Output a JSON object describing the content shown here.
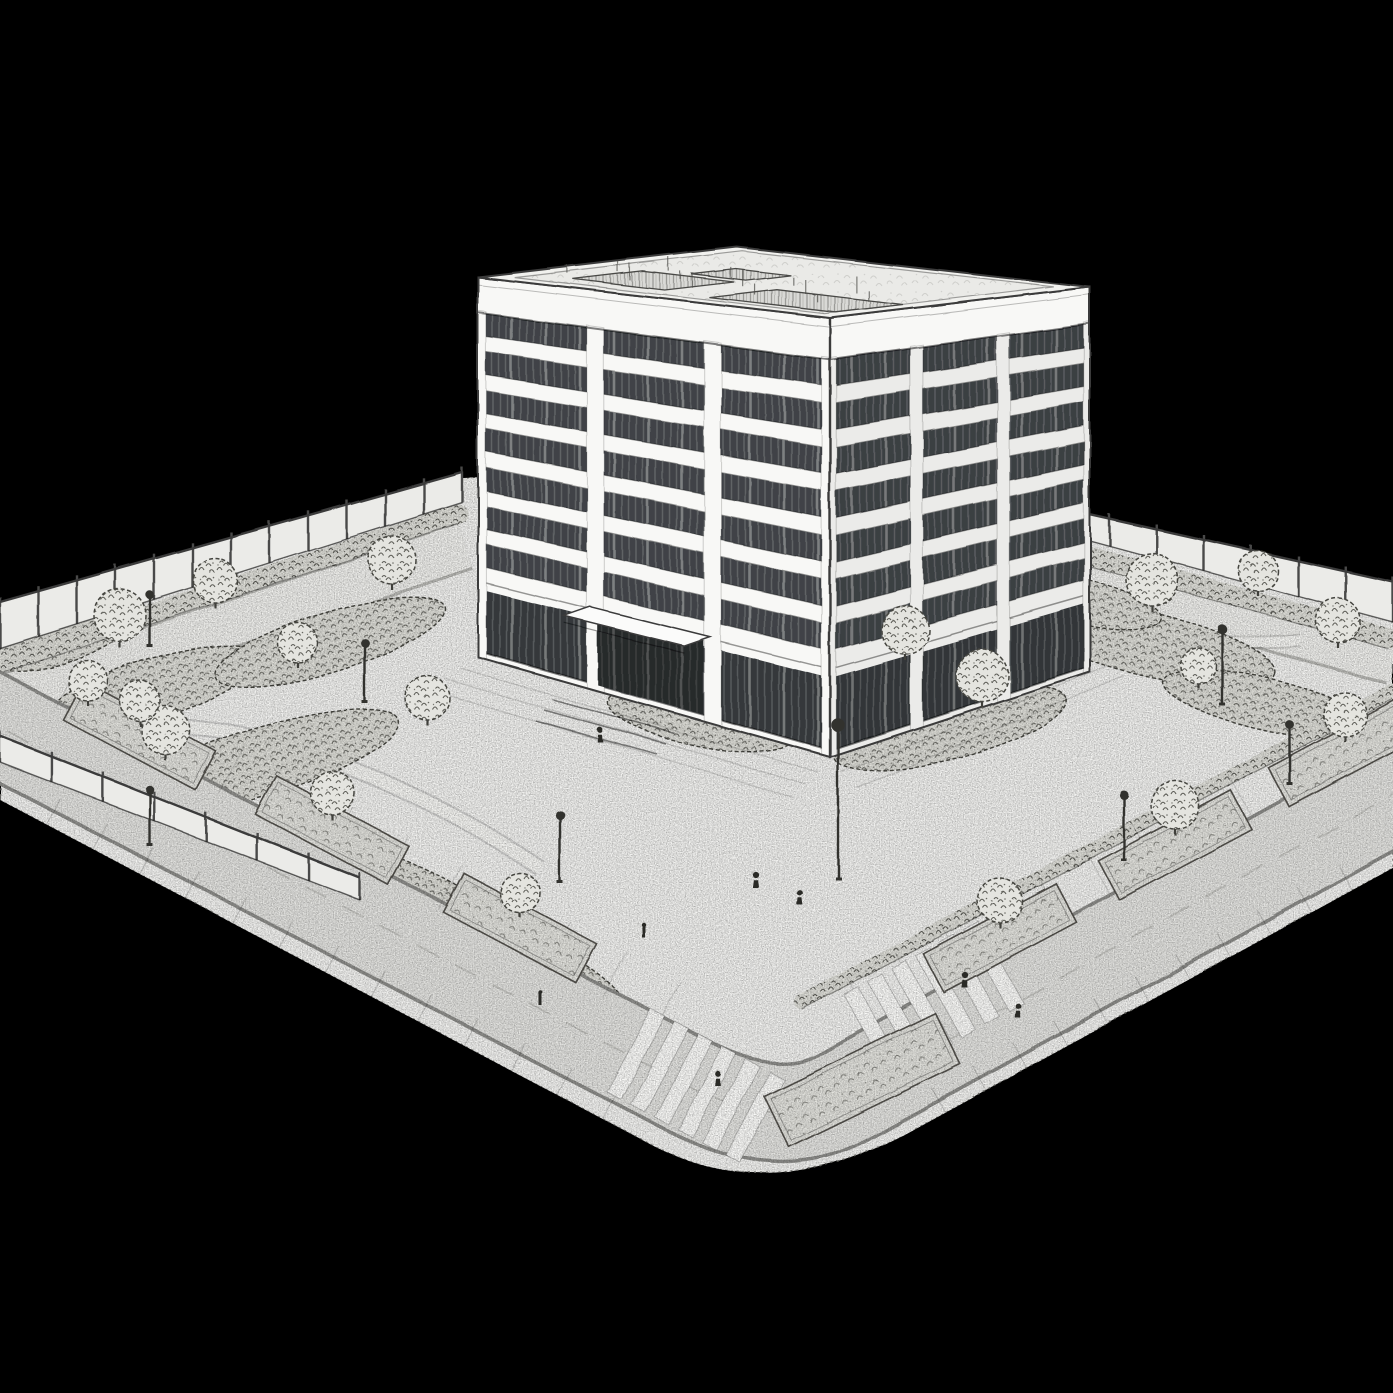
{
  "scene": {
    "title": "Pencil sketch of a mid-rise building on a landscaped city block",
    "description": "Black-and-white pencil-style architectural illustration of an eight-storey building with dark banded glazing and white spandrels, standing on a landscaped block with a perimeter fence, hedges, garden beds, trees and lamp posts. Two streets with zebra crosswalks meet at a rounded corner in the foreground and a few small pedestrians stand on the plaza and sidewalks. The scene floats on a black background, viewed from an elevated three-quarter angle.",
    "style": "pencil-sketch",
    "view": "elevated three-quarter"
  },
  "palette": {
    "background": "#000000",
    "paper": "#f3f3f1",
    "paper_shade": "#e9e9e6",
    "road": "#e4e4e1",
    "curb": "#8f8f8c",
    "line_dark": "#3b3b3b",
    "fence_panel": "#ebebe8",
    "window_glass": "#3f4347",
    "facade_white": "#f8f8f6",
    "vegetation_ink": "#45453f",
    "bed_fill": "#dfdfd9",
    "equipment_gray": "#d9d9d6",
    "crosswalk_stripe": "#fbfbf9"
  },
  "building": {
    "storeys_visible": 8,
    "window_bands_above_ground": 7,
    "bays_left_facade": 3,
    "bays_right_facade": 3,
    "parapet": true,
    "rooftop_equipment_units": 3,
    "entrance": {
      "facade": "left",
      "canopy": true,
      "steps": 3,
      "recessed": true
    }
  },
  "site": {
    "fence_panels_back_left": 12,
    "fence_panels_back_right": 8,
    "fence_panels_terrace_left": 7,
    "garden_trees": 12,
    "street_trees": 8,
    "street_planters": 7,
    "lamp_posts": 9,
    "pedestrians": 6,
    "bollards": 2,
    "streets": 2,
    "crosswalks": 2,
    "crosswalk_stripes_each": 6,
    "rounded_corner": true
  }
}
